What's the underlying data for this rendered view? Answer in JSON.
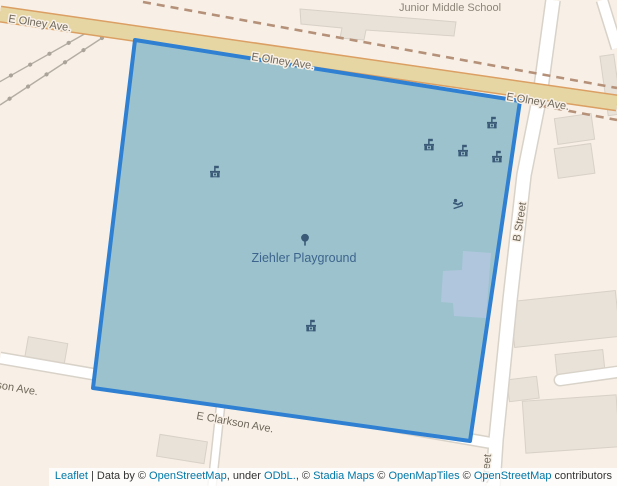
{
  "map": {
    "place_labels": {
      "school": "Junior Middle School",
      "playground": "Ziehler Playground"
    },
    "street_labels": {
      "olney_top_left": "E Olney Ave.",
      "olney_mid": "E Olney Ave.",
      "olney_right": "E Olney Ave.",
      "b_street": "B Street",
      "b_street_bottom": "B Street",
      "clarkson": "E Clarkson Ave.",
      "clarkson_left_partial": "son Ave."
    },
    "pois": [
      {
        "icon": "playground-equipment-icon",
        "x": 215,
        "y": 172
      },
      {
        "icon": "playground-equipment-icon",
        "x": 429,
        "y": 145
      },
      {
        "icon": "playground-equipment-icon",
        "x": 463,
        "y": 151
      },
      {
        "icon": "playground-equipment-icon",
        "x": 492,
        "y": 123
      },
      {
        "icon": "playground-equipment-icon",
        "x": 497,
        "y": 157
      },
      {
        "icon": "playground-equipment-icon",
        "x": 311,
        "y": 326
      },
      {
        "icon": "slide-icon",
        "x": 458,
        "y": 204
      },
      {
        "icon": "tree-icon",
        "x": 305,
        "y": 240
      }
    ],
    "colors": {
      "background": "#f8f0e6",
      "park_fill": "#9cc3cd",
      "park_outline": "#2f80d2",
      "inner_building": "#b0c6dd",
      "major_road": "#e6d6a3",
      "major_road_casing": "#db9f63",
      "minor_road": "#ffffff",
      "minor_road_casing": "#d8d2c9",
      "boundary_dash": "#b5917a",
      "railway": "#b3ada3",
      "building_fill": "#e8e2d9",
      "building_stroke": "#d8d1c7",
      "poi_icon": "#3a5a78",
      "street_label": "#6f685a",
      "school_label": "#8d8578",
      "park_label": "#3d648c",
      "link": "#0078a8"
    }
  },
  "attribution": {
    "leaflet": "Leaflet",
    "sep1": " | Data by © ",
    "osm1": "OpenStreetMap",
    "sep2": ", under ",
    "odbl": "ODbL.",
    "sep3": ", © ",
    "stadia": "Stadia Maps",
    "sep4": " © ",
    "openmaptiles": "OpenMapTiles",
    "sep5": " © ",
    "osm2": "OpenStreetMap",
    "sep6": " contributors"
  }
}
